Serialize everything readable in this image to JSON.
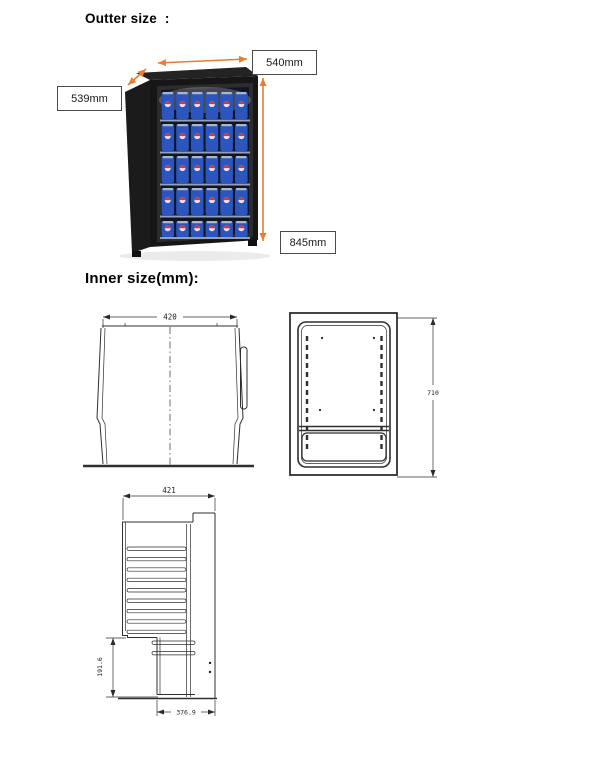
{
  "page": {
    "outer_title": "Outter size  :",
    "inner_title": "Inner size(mm):"
  },
  "outer_size": {
    "width": "540mm",
    "depth": "539mm",
    "height": "845mm"
  },
  "inner_size": {
    "front_width": "420",
    "cavity_height": "710",
    "section_width": "421",
    "step_height": "191.6",
    "recess_width": "376.9"
  },
  "illustration": {
    "accent_arrow_color": "#E67E33",
    "cabinet_color": "#161616",
    "can_color": "#2d55c0",
    "shelf_rows": 5,
    "cans_per_row": 6
  }
}
